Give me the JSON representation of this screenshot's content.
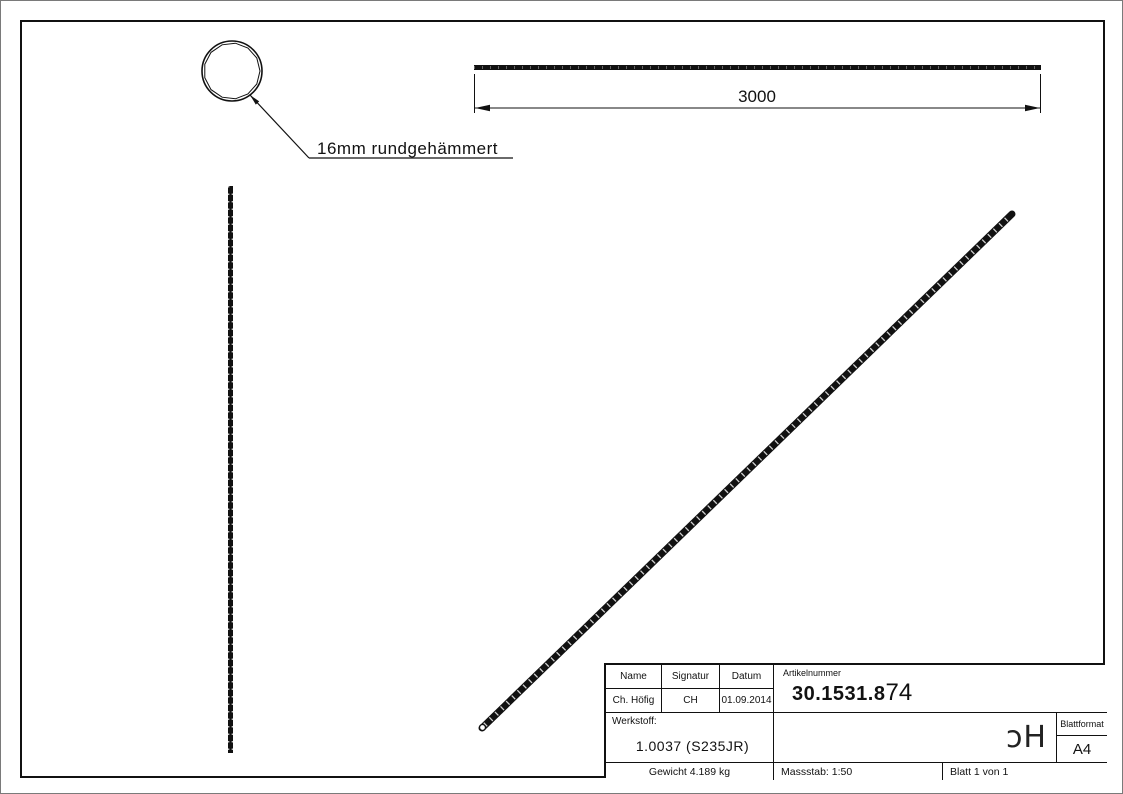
{
  "drawing": {
    "callout_label": "16mm rundgehämmert",
    "dimension_length": "3000"
  },
  "title_block": {
    "headers": {
      "name": "Name",
      "signatur": "Signatur",
      "datum": "Datum",
      "artikelnummer": "Artikelnummer"
    },
    "values": {
      "name": "Ch. Höfig",
      "signatur": "CH",
      "datum": "01.09.2014",
      "artikelnummer_main": "30.1531.8",
      "artikelnummer_suffix": "74"
    },
    "werkstoff_label": "Werkstoff:",
    "werkstoff_value": "1.0037 (S235JR)",
    "logo_text": "ɔH",
    "blattformat_label": "Blattformat",
    "blattformat_value": "A4",
    "gewicht": "Gewicht 4.189 kg",
    "massstab": "Massstab: 1:50",
    "blatt": "Blatt 1 von 1"
  },
  "colors": {
    "line": "#111111",
    "paper": "#ffffff"
  }
}
